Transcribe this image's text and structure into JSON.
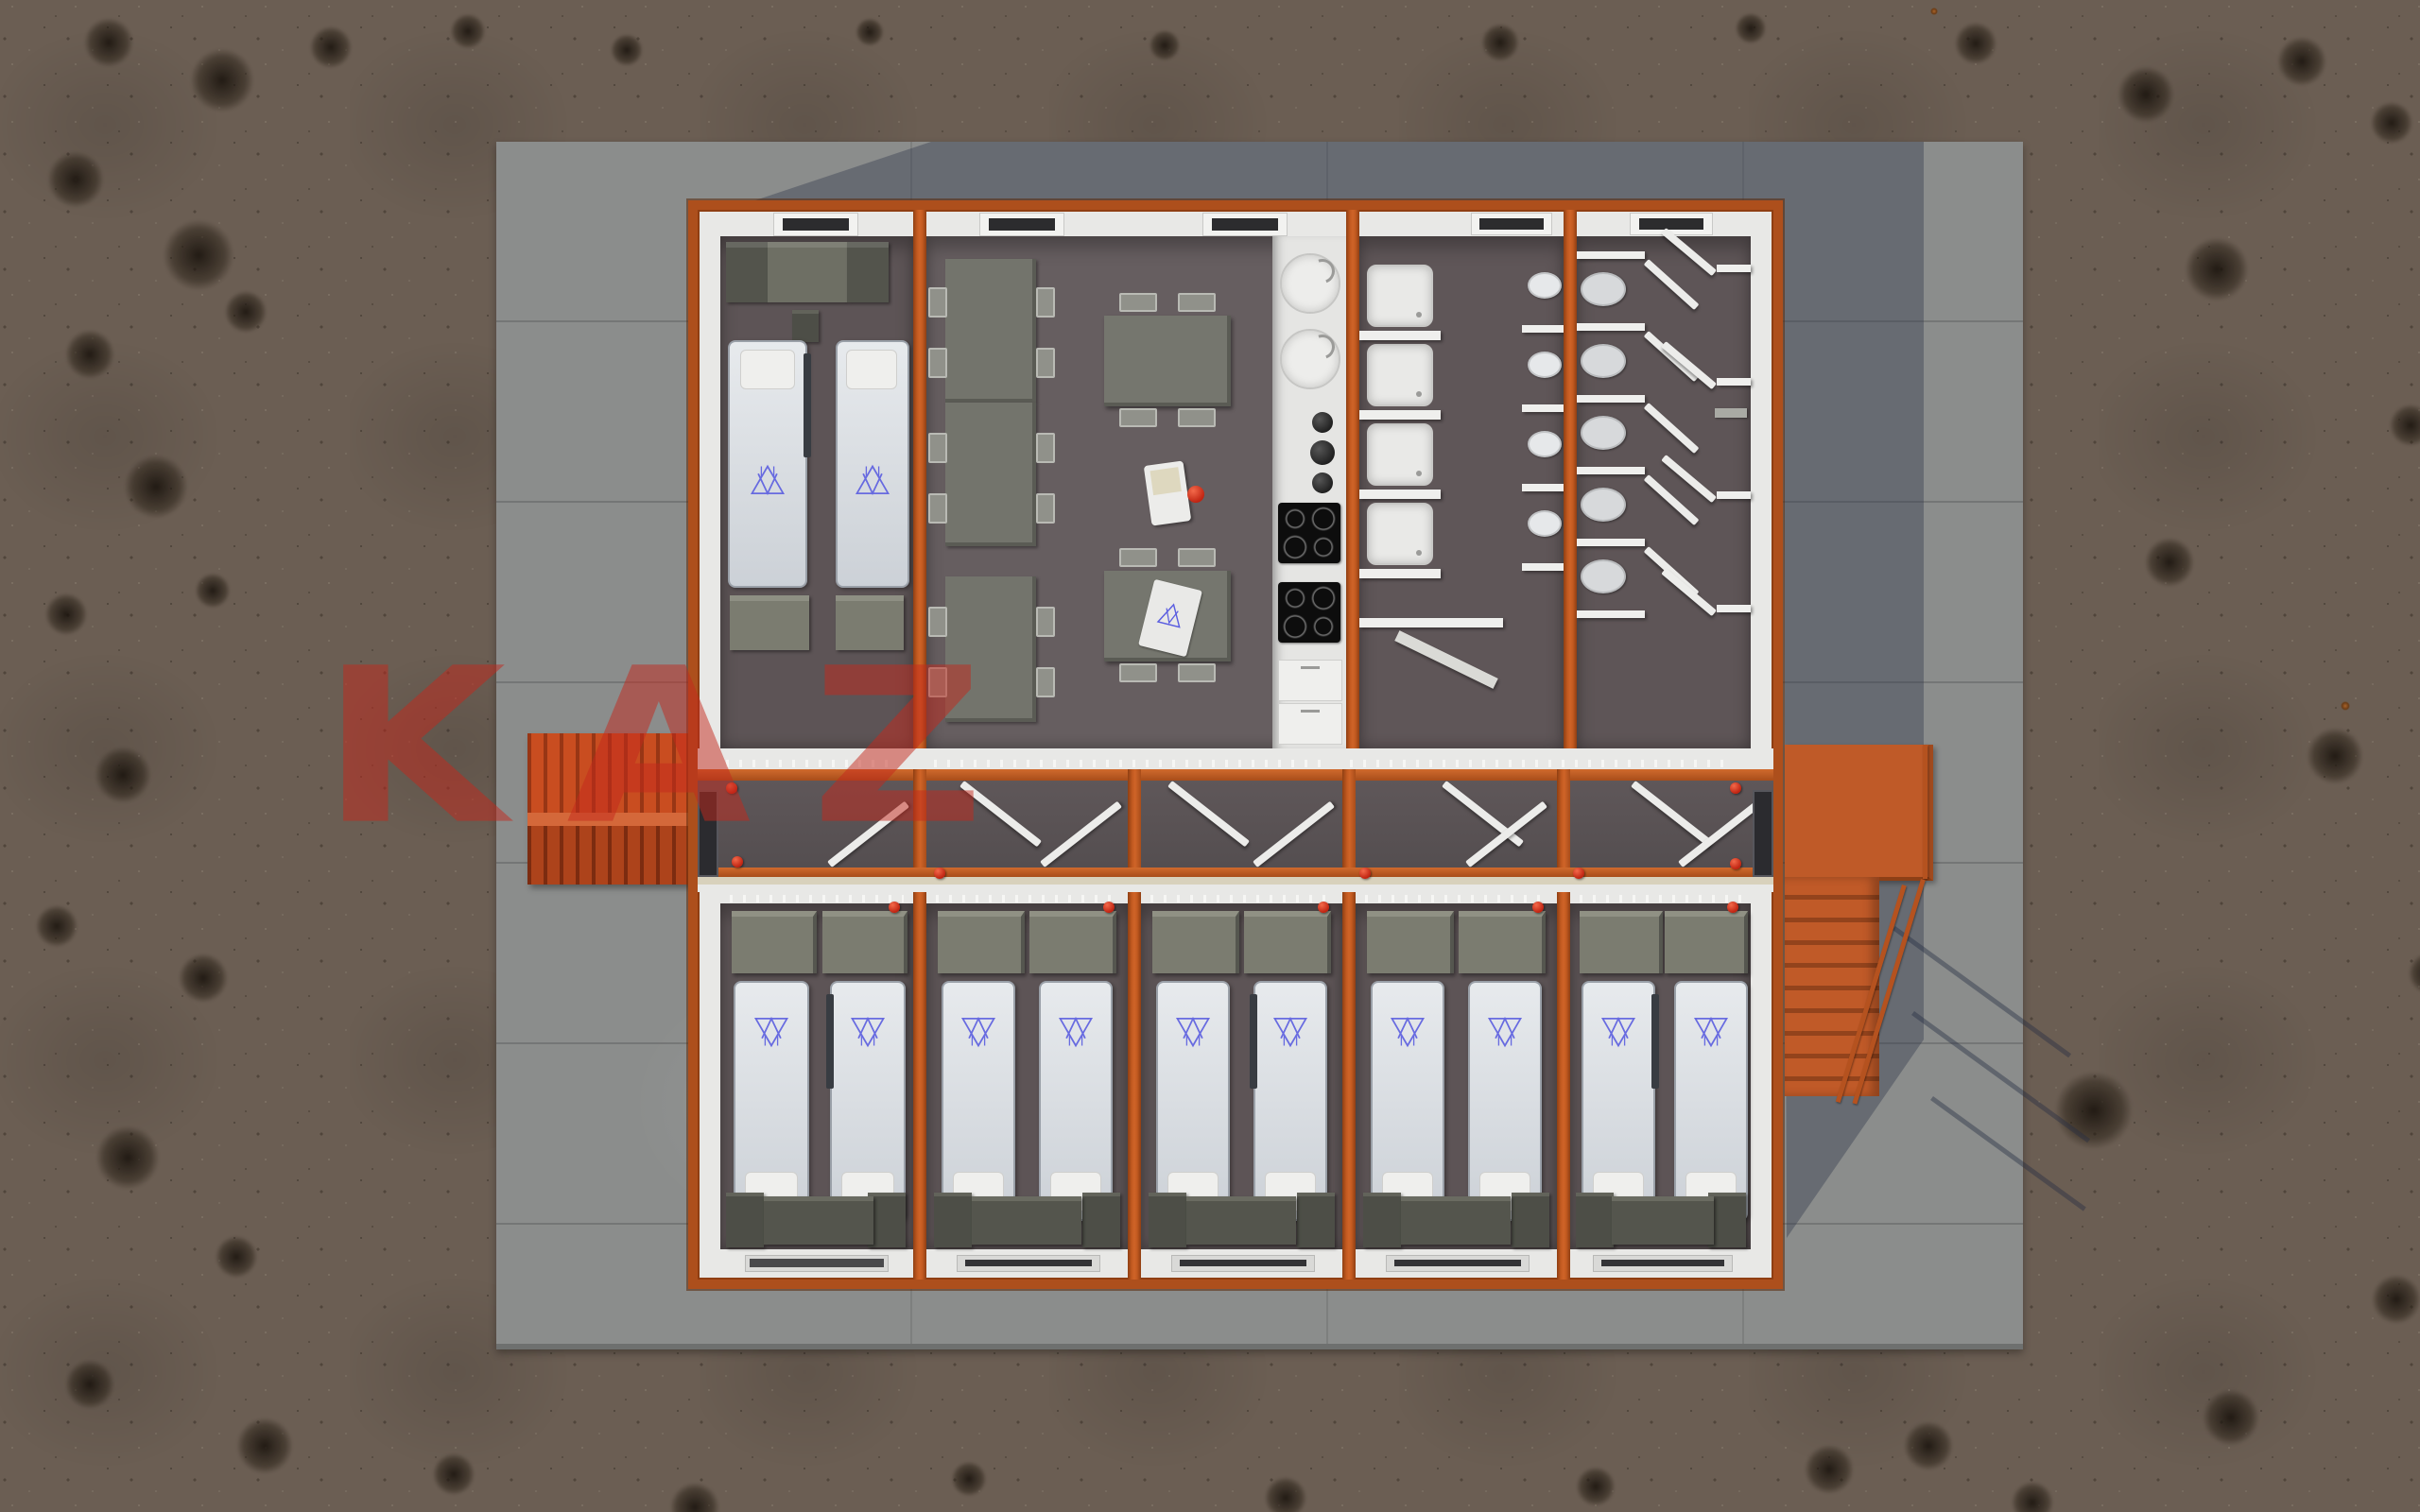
{
  "watermark": {
    "text": "KAZ"
  },
  "palette": {
    "frame_orange": "#ad4f1c",
    "bright_orange": "#cf6428",
    "canopy_orange": "#c94d20",
    "stairs_orange": "#c05a28",
    "watermark_red": "#c3271b",
    "extinguisher_red": "#d2301e",
    "concrete": "#8b8d8c",
    "concrete_shadow": "#2c354a",
    "ground_gravel": "#6b5e53",
    "wall_white": "#e8e8e6",
    "floor_dark": "#5d5456",
    "furniture_olive": "#7b7c70",
    "furniture_dark": "#4d4e47",
    "bed_white": "#dde0e4",
    "logo_blue": "#5b5ee0"
  },
  "scene": {
    "type": "top-down 3D architectural render",
    "subject": "modular container dormitory building on a concrete pad with gravel surroundings",
    "modules_top_row": [
      {
        "name": "bedroom-nw",
        "beds": 2,
        "wall_cabinets": 3,
        "foot_chests": 2
      },
      {
        "name": "dining-kitchen",
        "long_tables": 3,
        "dining_tables": 2,
        "cooktops": 2,
        "kitchen_sinks": 2,
        "bowls": 3,
        "water_dispenser": 1,
        "menu_cards": 1
      },
      {
        "name": "washroom",
        "showers": 4,
        "wash_basins": 4
      },
      {
        "name": "toilet-room",
        "toilets": 5,
        "stall_doors": 9
      }
    ],
    "modules_bottom_row": [
      {
        "name": "bedroom",
        "beds": 2,
        "wardrobes": 2
      },
      {
        "name": "bedroom",
        "beds": 2,
        "wardrobes": 2
      },
      {
        "name": "bedroom",
        "beds": 2,
        "wardrobes": 2
      },
      {
        "name": "bedroom",
        "beds": 2,
        "wardrobes": 2
      },
      {
        "name": "bedroom",
        "beds": 2,
        "wardrobes": 2
      }
    ],
    "corridor": {
      "orientation": "horizontal",
      "doors": 9,
      "exits": 2,
      "fire_extinguishers": 7
    },
    "exterior": {
      "west_entrance_canopy": 1,
      "east_landing": 1,
      "east_stairs": 1,
      "bed_logo": "blue triangle monogram"
    }
  }
}
